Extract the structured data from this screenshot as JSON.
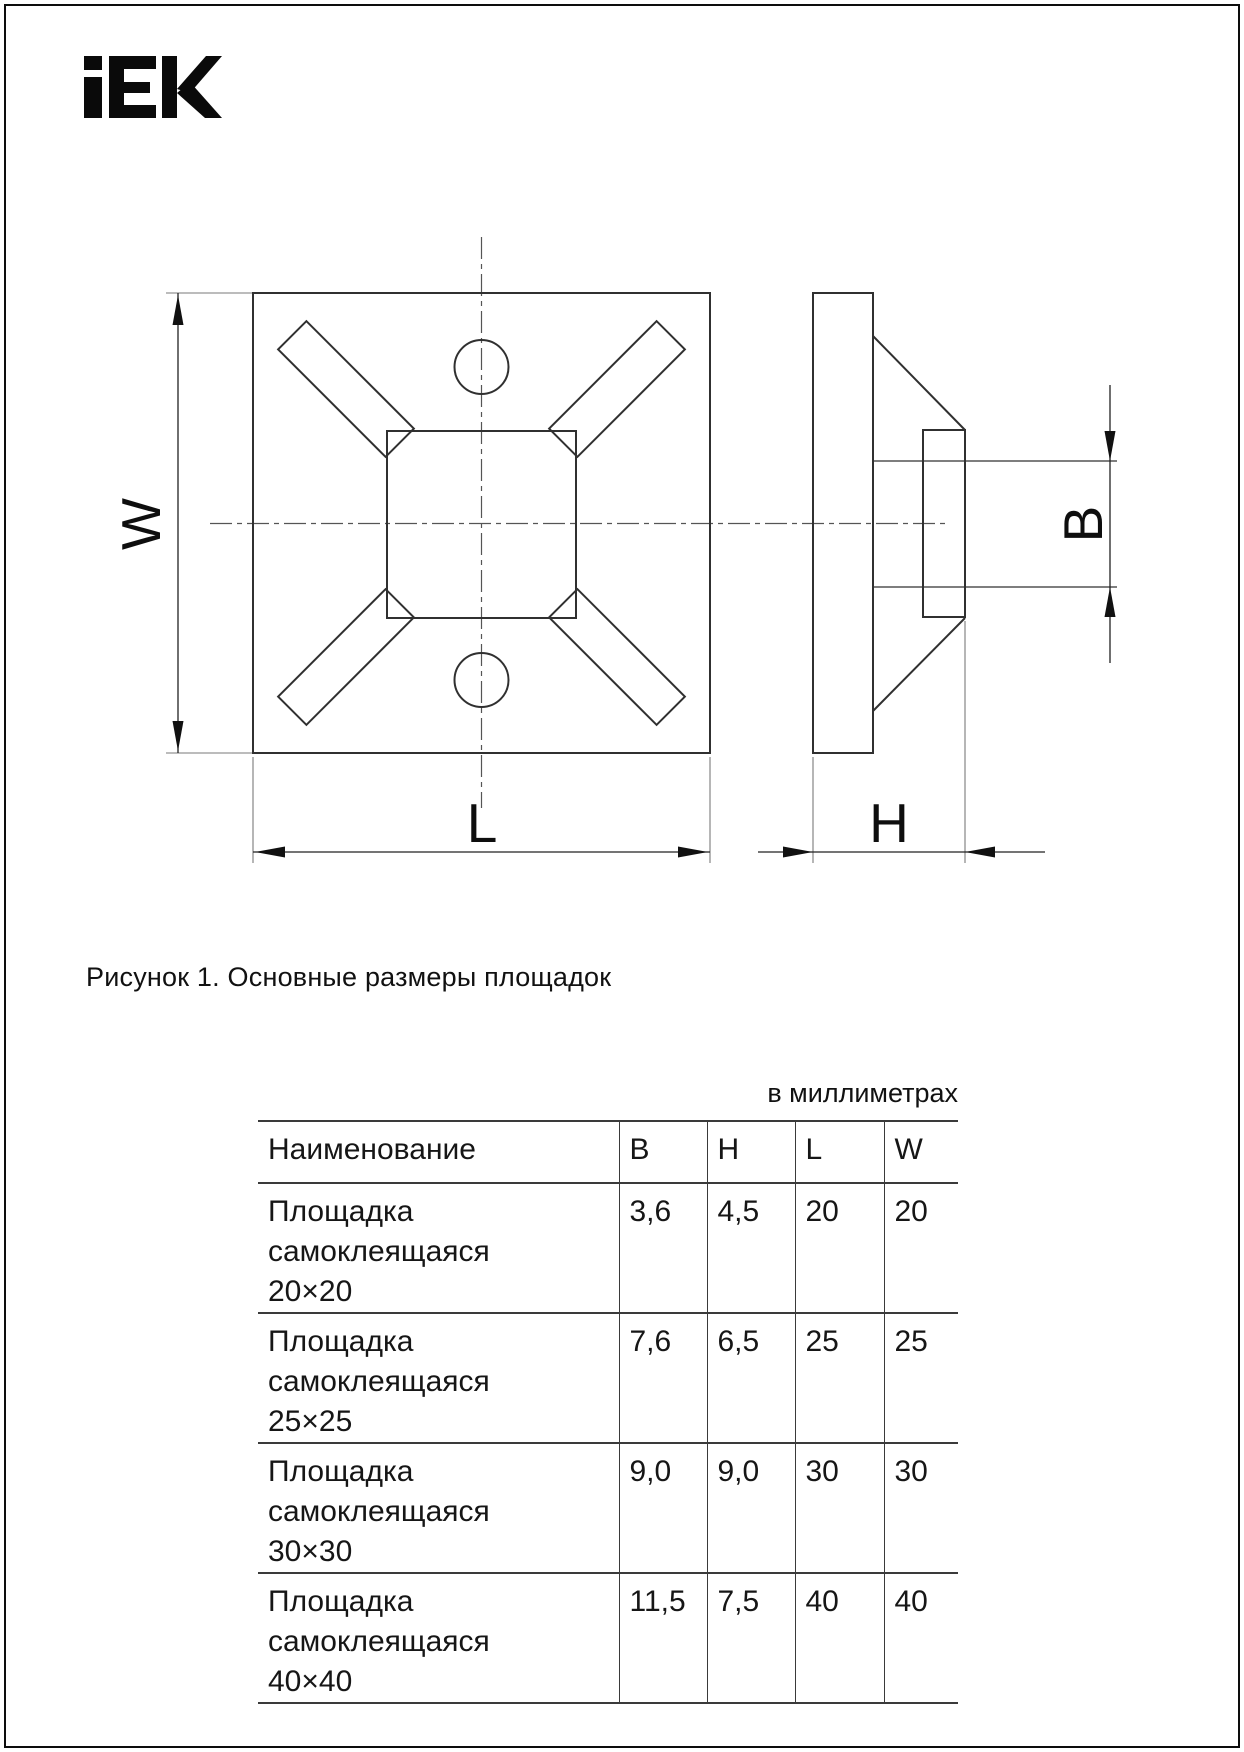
{
  "brand": {
    "logo": "IEK"
  },
  "figure": {
    "caption": "Рисунок 1. Основные размеры площадок",
    "units_note": "в миллиметрах",
    "dim_labels": {
      "w": "W",
      "l": "L",
      "h": "H",
      "b": "B"
    }
  },
  "table": {
    "headers": [
      "Наименование",
      "B",
      "H",
      "L",
      "W"
    ],
    "rows": [
      {
        "name_line1": "Площадка самоклеящаяся",
        "name_line2": "20×20",
        "b": "3,6",
        "h": "4,5",
        "l": "20",
        "w": "20"
      },
      {
        "name_line1": "Площадка самоклеящаяся",
        "name_line2": "25×25",
        "b": "7,6",
        "h": "6,5",
        "l": "25",
        "w": "25"
      },
      {
        "name_line1": "Площадка самоклеящаяся",
        "name_line2": "30×30",
        "b": "9,0",
        "h": "9,0",
        "l": "30",
        "w": "30"
      },
      {
        "name_line1": "Площадка самоклеящаяся",
        "name_line2": "40×40",
        "b": "11,5",
        "h": "7,5",
        "l": "40",
        "w": "40"
      }
    ]
  }
}
